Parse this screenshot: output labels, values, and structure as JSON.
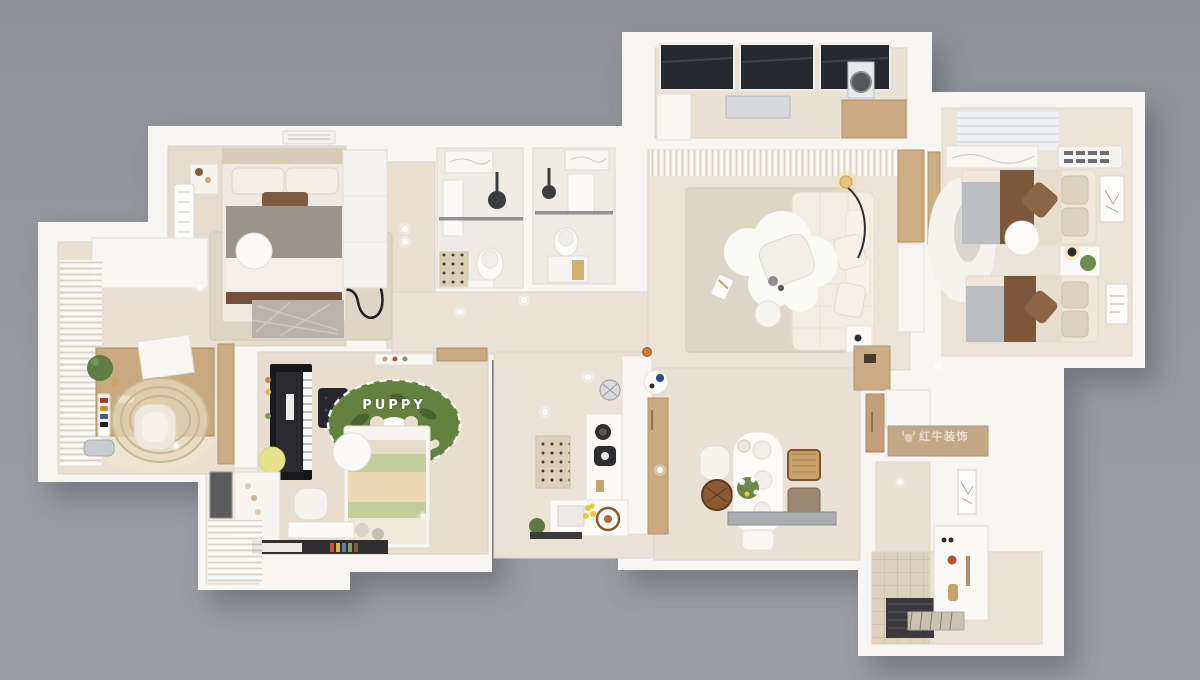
{
  "image": {
    "kind": "3D rendered top-down apartment floor plan (dollhouse view)",
    "background_color": "#97989e",
    "wall_color": "#f7f6f2"
  },
  "labels": {
    "rug_text": "PUPPY",
    "watermark": {
      "text": "红牛装饰",
      "icon": "bull-logo-icon"
    }
  },
  "palette": {
    "background": "#97989e",
    "walls": "#f7f6f2",
    "floor_warm": "#e7decf",
    "floor_light": "#efece6",
    "wood": "#c9aa81",
    "sofa_cream": "#f3eee2",
    "bedding_brown": "#7b573b",
    "rug_green": "#64823f",
    "glass_roof_dark": "#26292e",
    "lemon_yellow": "#e9c832",
    "stool_yellow": "#e6e28c"
  },
  "rooms": [
    {
      "id": "master-bedroom",
      "name": "Master bedroom",
      "position": "top-left",
      "furniture": [
        "double bed",
        "nightstands",
        "round side table",
        "line-art area rug",
        "radiator",
        "AC grille"
      ]
    },
    {
      "id": "walk-in-closet",
      "name": "Walk-in closet",
      "position": "top-center-left",
      "furniture": [
        "white wardrobe"
      ]
    },
    {
      "id": "bathroom-left",
      "name": "Bathroom 1",
      "position": "top-center",
      "furniture": [
        "shower with glass screen",
        "vanity sink",
        "toilet",
        "dotted mat"
      ]
    },
    {
      "id": "bathroom-right",
      "name": "Bathroom 2",
      "position": "top-center",
      "furniture": [
        "shower with glass screen",
        "vanity sink",
        "toilet",
        "gold bath mat"
      ]
    },
    {
      "id": "laundry-balcony",
      "name": "Laundry balcony",
      "position": "top",
      "furniture": [
        "dark glass roof panels",
        "drying rack",
        "washing machine",
        "wood counter",
        "white cabinet"
      ]
    },
    {
      "id": "living-room",
      "name": "Living room",
      "position": "center-right",
      "furniture": [
        "cream sectional sofa",
        "cloud-shaped coffee table",
        "area rug",
        "arc floor lamp",
        "side table",
        "sheer curtains",
        "wood media cabinet"
      ]
    },
    {
      "id": "dining-area",
      "name": "Dining area",
      "position": "bottom-center-right",
      "furniture": [
        "oval dining table with flowers",
        "white dining chair",
        "rattan chairs",
        "wooden stool chair",
        "gray stone bench"
      ]
    },
    {
      "id": "kitchen",
      "name": "Kitchen",
      "position": "bottom-center",
      "furniture": [
        "white counters",
        "coffee machine",
        "sink with lemons",
        "dotted runner rug",
        "tall wood pantry",
        "round serving tray",
        "potted plant",
        "wire stool"
      ]
    },
    {
      "id": "kids-bedroom",
      "name": "Kids bedroom",
      "position": "bottom-left",
      "furniture": [
        "upright piano",
        "tufted piano bench",
        "yellow stool",
        "green PUPPY dog rug",
        "striped kids bed",
        "round bedside table",
        "desk with chair",
        "bookshelf with colorful books",
        "wardrobe with hooks"
      ]
    },
    {
      "id": "kids-balcony",
      "name": "Kids balcony",
      "position": "bottom-left-corner",
      "furniture": [
        "sheer curtains",
        "dark glass panel"
      ]
    },
    {
      "id": "study",
      "name": "Study / window office",
      "position": "left",
      "furniture": [
        "wood desk",
        "desk books and monitor",
        "potted plant",
        "lounge chair",
        "striped oval rug",
        "white storage cabinet",
        "sheer curtains",
        "metal bin"
      ]
    },
    {
      "id": "twin-bedroom",
      "name": "Twin kids bedroom",
      "position": "right",
      "furniture": [
        "twin bed 1",
        "twin bed 2",
        "nightstand with lamp and plant",
        "round stool",
        "fluffy rug",
        "two wall art frames",
        "window blinds",
        "marble sill",
        "AC grille"
      ]
    },
    {
      "id": "entry-hall",
      "name": "Entry hall",
      "position": "bottom-right",
      "furniture": [
        "shoe cabinet with decor",
        "wall art",
        "striped door mat",
        "wood storage cabinets",
        "tiled floor strip"
      ]
    }
  ]
}
